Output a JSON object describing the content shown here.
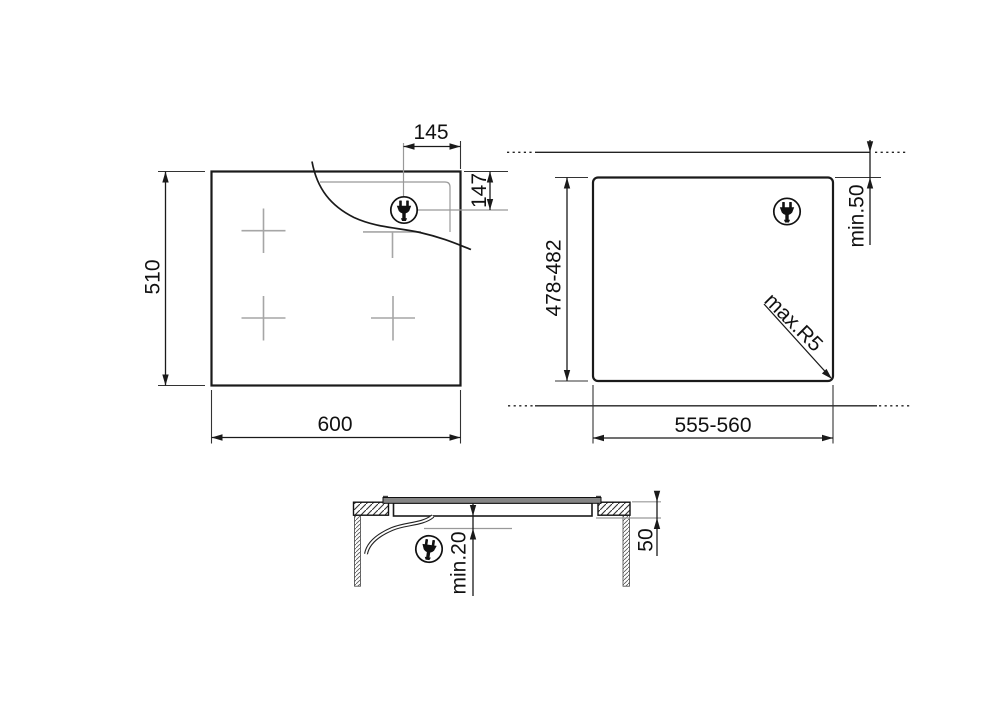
{
  "drawing": {
    "title": "hob-installation-dimensions",
    "hob_top_view": {
      "width_label": "600",
      "height_label": "510",
      "plug_offset_horizontal_label": "145",
      "plug_offset_vertical_label": "147"
    },
    "cutout_view": {
      "width_label": "555-560",
      "height_label": "478-482",
      "rear_clearance_label": "min.50",
      "corner_radius_label": "max.R5"
    },
    "section_view": {
      "under_clearance_label": "min.20",
      "depth_label": "50"
    },
    "icons": {
      "plug": "plug-icon"
    },
    "colors": {
      "line": "#1a1a1a",
      "secondary_line": "#999999",
      "text": "#111111",
      "background": "#ffffff",
      "glass_fill": "#858585"
    }
  }
}
